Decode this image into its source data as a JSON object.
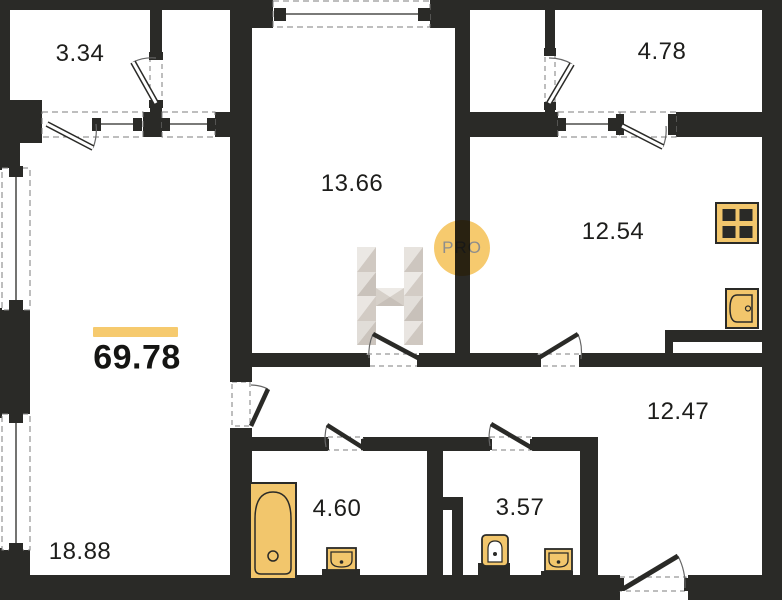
{
  "plan": {
    "total_area": "69.78",
    "rooms": {
      "balcony_left": "3.34",
      "balcony_right": "4.78",
      "bedroom": "13.66",
      "kitchen": "12.54",
      "hallway": "12.47",
      "bathroom": "4.60",
      "toilet": "3.57",
      "living_room": "18.88"
    },
    "watermark": {
      "letter": "H",
      "badge": "PRO"
    },
    "colors": {
      "wall": "#2a2a27",
      "fixture_yellow": "#f2c66c",
      "accent_bar": "#f6ca6e",
      "badge_fill": "#f6ca6e",
      "badge_text": "#8d8d8d"
    }
  }
}
